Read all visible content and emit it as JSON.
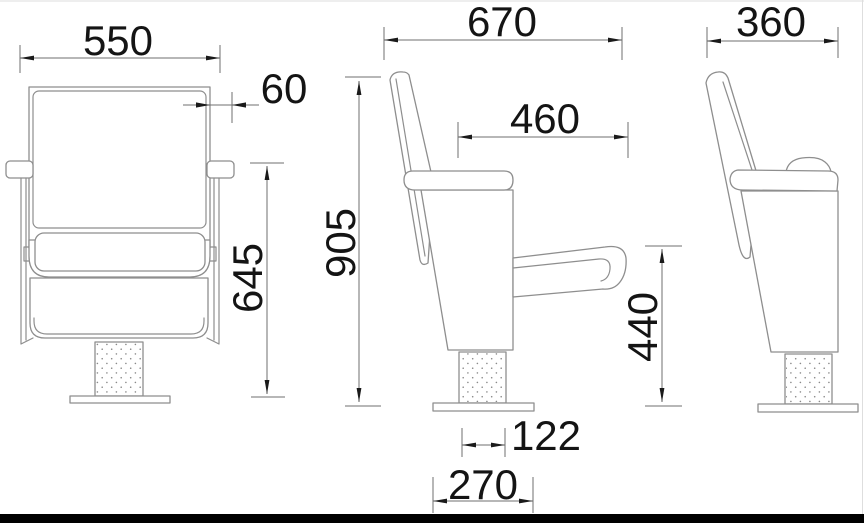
{
  "drawing": {
    "front_view": {
      "overall_width": "550",
      "backrest_offset": "60",
      "armrest_height": "645"
    },
    "side_view": {
      "overall_depth": "670",
      "armrest_depth": "460",
      "overall_height": "905",
      "seat_height": "440",
      "pedestal_width": "122",
      "base_width": "270"
    },
    "back_view": {
      "overall_width": "360"
    }
  }
}
